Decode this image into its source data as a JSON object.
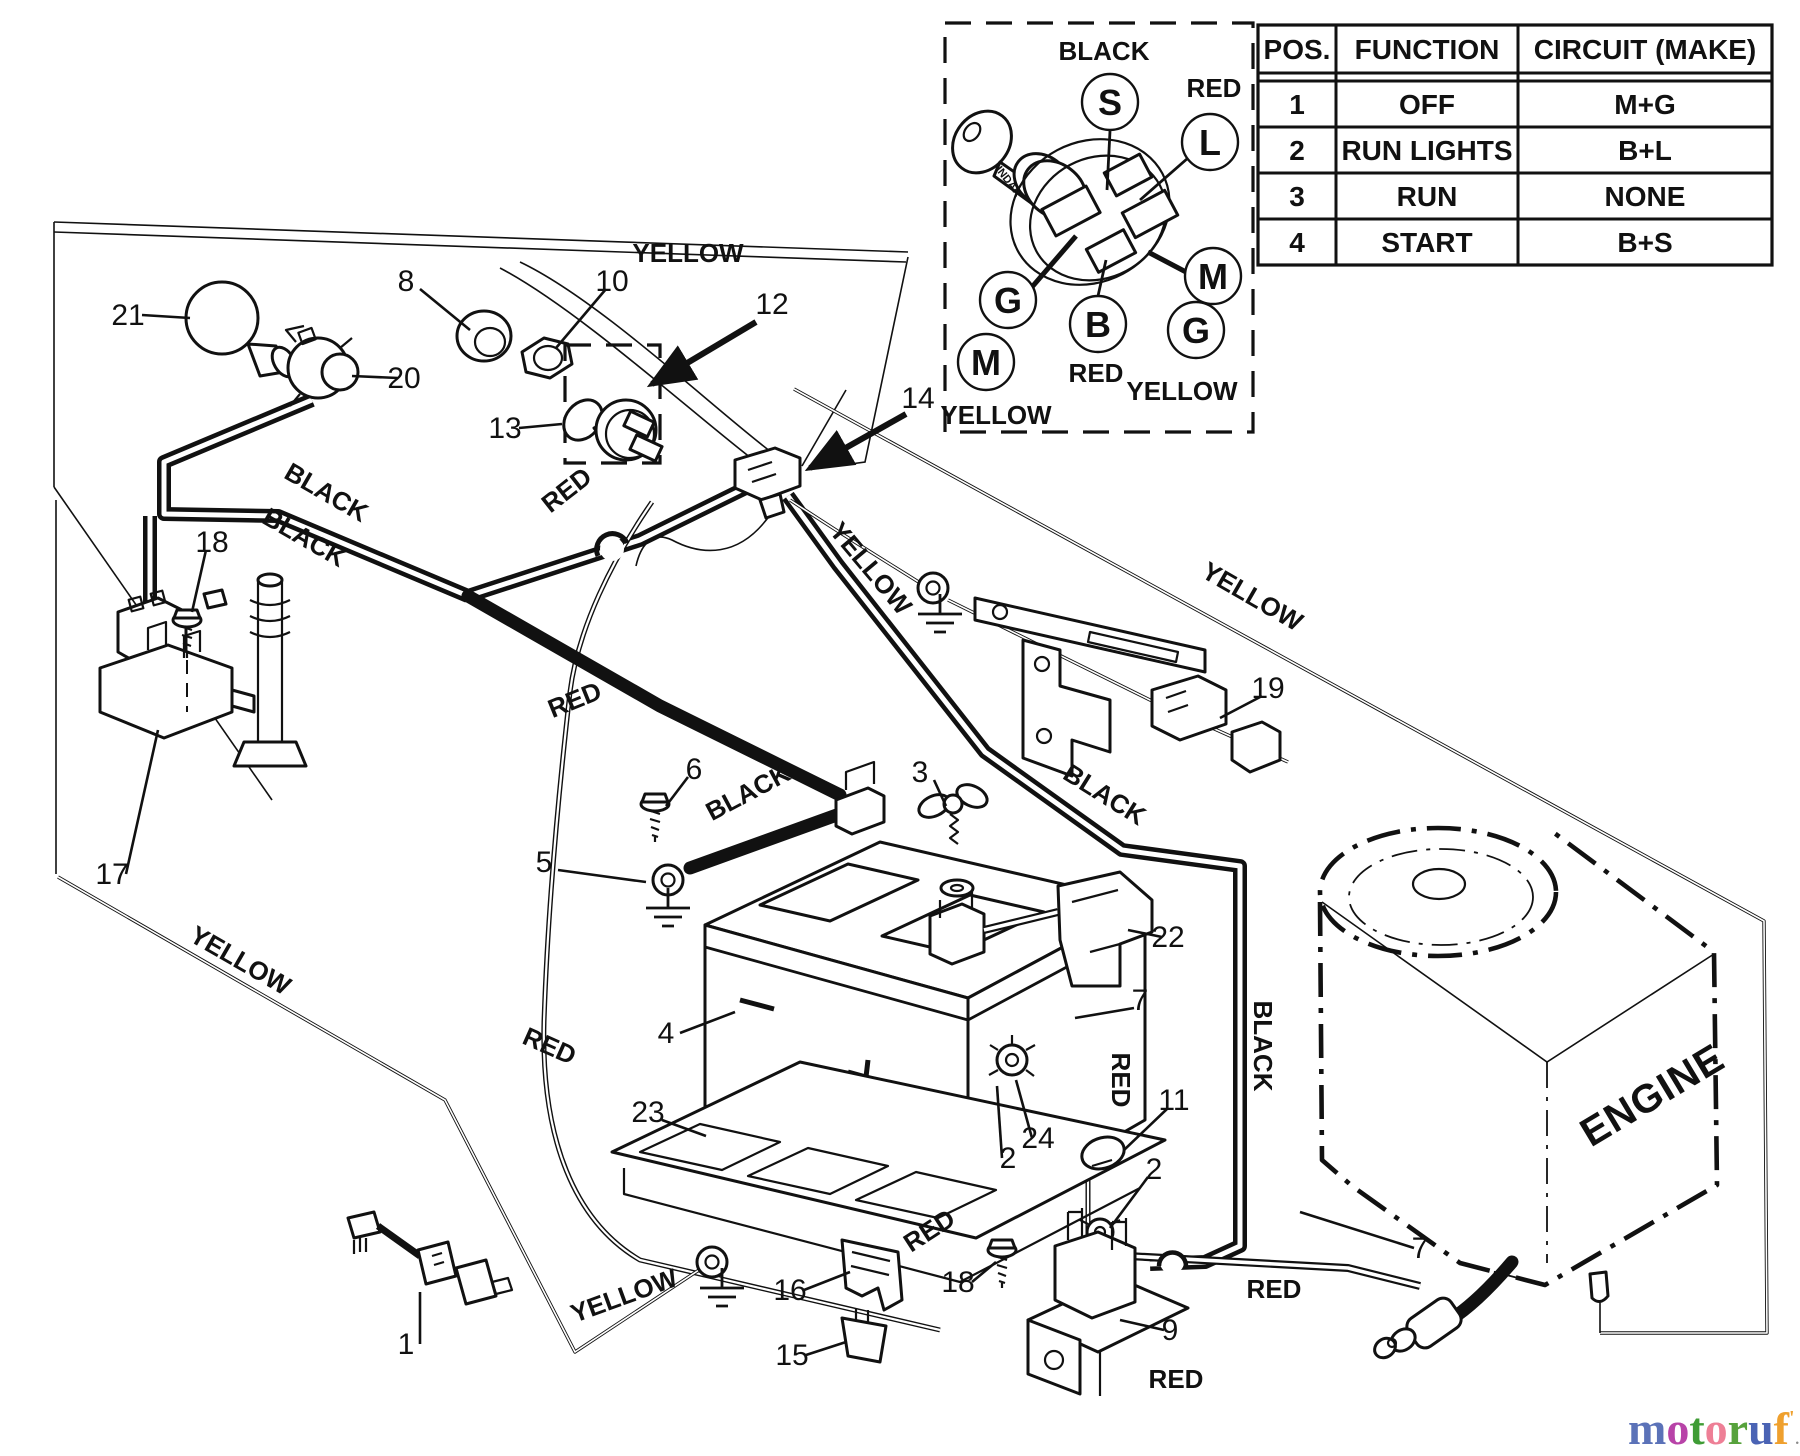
{
  "diagram": {
    "engine_label": "ENGINE",
    "inset": {
      "key_brand": "INDAK",
      "terminals": [
        {
          "t": "S",
          "x": 1110,
          "y": 102
        },
        {
          "t": "L",
          "x": 1210,
          "y": 142
        },
        {
          "t": "M",
          "x": 1213,
          "y": 276
        },
        {
          "t": "G",
          "x": 1196,
          "y": 330
        },
        {
          "t": "B",
          "x": 1098,
          "y": 324
        },
        {
          "t": "G",
          "x": 1008,
          "y": 300
        },
        {
          "t": "M",
          "x": 986,
          "y": 362
        }
      ],
      "wire_labels": [
        {
          "text": "BLACK",
          "x": 1104,
          "y": 60
        },
        {
          "text": "RED",
          "x": 1214,
          "y": 97
        },
        {
          "text": "RED",
          "x": 1096,
          "y": 382
        },
        {
          "text": "YELLOW",
          "x": 1182,
          "y": 400
        },
        {
          "text": "YELLOW",
          "x": 996,
          "y": 424
        }
      ]
    },
    "table": {
      "headers": [
        "POS.",
        "FUNCTION",
        "CIRCUIT  (MAKE)"
      ],
      "rows": [
        [
          "1",
          "OFF",
          "M+G"
        ],
        [
          "2",
          "RUN LIGHTS",
          "B+L"
        ],
        [
          "3",
          "RUN",
          "NONE"
        ],
        [
          "4",
          "START",
          "B+S"
        ]
      ]
    },
    "wire_color_labels": [
      {
        "text": "YELLOW",
        "x": 688,
        "y": 262,
        "rot": 0
      },
      {
        "text": "BLACK",
        "x": 322,
        "y": 500,
        "rot": 30
      },
      {
        "text": "BLACK",
        "x": 300,
        "y": 545,
        "rot": 30
      },
      {
        "text": "RED",
        "x": 572,
        "y": 497,
        "rot": -38
      },
      {
        "text": "RED",
        "x": 578,
        "y": 708,
        "rot": -22
      },
      {
        "text": "YELLOW",
        "x": 236,
        "y": 968,
        "rot": 30
      },
      {
        "text": "RED",
        "x": 546,
        "y": 1054,
        "rot": 24
      },
      {
        "text": "YELLOW",
        "x": 864,
        "y": 574,
        "rot": 50
      },
      {
        "text": "YELLOW",
        "x": 1248,
        "y": 604,
        "rot": 30
      },
      {
        "text": "BLACK",
        "x": 1100,
        "y": 802,
        "rot": 32
      },
      {
        "text": "BLACK",
        "x": 752,
        "y": 800,
        "rot": -28
      },
      {
        "text": "RED",
        "x": 1112,
        "y": 1080,
        "rot": 90
      },
      {
        "text": "BLACK",
        "x": 1254,
        "y": 1046,
        "rot": 90
      },
      {
        "text": "RED",
        "x": 934,
        "y": 1238,
        "rot": -33
      },
      {
        "text": "RED",
        "x": 1274,
        "y": 1298,
        "rot": 0
      },
      {
        "text": "RED",
        "x": 1176,
        "y": 1388,
        "rot": 0
      },
      {
        "text": "YELLOW",
        "x": 627,
        "y": 1304,
        "rot": -20
      }
    ],
    "part_labels": [
      {
        "n": "21",
        "x": 128,
        "y": 325,
        "tx": 190,
        "ty": 318
      },
      {
        "n": "8",
        "x": 406,
        "y": 291,
        "tx": 470,
        "ty": 330
      },
      {
        "n": "20",
        "x": 404,
        "y": 388,
        "tx": 352,
        "ty": 376
      },
      {
        "n": "10",
        "x": 612,
        "y": 291,
        "tx": 556,
        "ty": 348
      },
      {
        "n": "13",
        "x": 505,
        "y": 438,
        "tx": 562,
        "ty": 424
      },
      {
        "n": "12",
        "x": 772,
        "y": 314,
        "tx": 0,
        "ty": 0
      },
      {
        "n": "14",
        "x": 918,
        "y": 408,
        "tx": 0,
        "ty": 0
      },
      {
        "n": "18",
        "x": 212,
        "y": 552,
        "tx": 192,
        "ty": 612
      },
      {
        "n": "17",
        "x": 112,
        "y": 884,
        "tx": 158,
        "ty": 730
      },
      {
        "n": "19",
        "x": 1268,
        "y": 698,
        "tx": 1220,
        "ty": 718
      },
      {
        "n": "6",
        "x": 694,
        "y": 779,
        "tx": 666,
        "ty": 806
      },
      {
        "n": "5",
        "x": 544,
        "y": 872,
        "tx": 646,
        "ty": 882
      },
      {
        "n": "3",
        "x": 920,
        "y": 782,
        "tx": 946,
        "ty": 806
      },
      {
        "n": "4",
        "x": 666,
        "y": 1043,
        "tx": 735,
        "ty": 1012
      },
      {
        "n": "23",
        "x": 648,
        "y": 1122,
        "tx": 706,
        "ty": 1136
      },
      {
        "n": "22",
        "x": 1168,
        "y": 947,
        "tx": 1128,
        "ty": 930
      },
      {
        "n": "7",
        "x": 1140,
        "y": 1010,
        "tx": 1075,
        "ty": 1018
      },
      {
        "n": "11",
        "x": 1174,
        "y": 1110,
        "tx": 1124,
        "ty": 1150
      },
      {
        "n": "2",
        "x": 1154,
        "y": 1179,
        "tx": 1110,
        "ty": 1228
      },
      {
        "n": "24",
        "x": 1038,
        "y": 1148,
        "tx": 1016,
        "ty": 1080
      },
      {
        "n": "2",
        "x": 1008,
        "y": 1168,
        "tx": 997,
        "ty": 1086
      },
      {
        "n": "1",
        "x": 406,
        "y": 1354,
        "tx": 420,
        "ty": 1292
      },
      {
        "n": "16",
        "x": 790,
        "y": 1300,
        "tx": 850,
        "ty": 1272
      },
      {
        "n": "15",
        "x": 792,
        "y": 1365,
        "tx": 846,
        "ty": 1342
      },
      {
        "n": "18",
        "x": 958,
        "y": 1292,
        "tx": 996,
        "ty": 1262
      },
      {
        "n": "9",
        "x": 1170,
        "y": 1340,
        "tx": 1120,
        "ty": 1320
      },
      {
        "n": "7",
        "x": 1420,
        "y": 1258,
        "tx": 1300,
        "ty": 1212
      }
    ],
    "logo": {
      "letters": [
        {
          "ch": "m",
          "color": "#5b72b8"
        },
        {
          "ch": "o",
          "color": "#b843a8"
        },
        {
          "ch": "t",
          "color": "#3f9c35"
        },
        {
          "ch": "o",
          "color": "#ee7f96"
        },
        {
          "ch": "r",
          "color": "#57a23c"
        },
        {
          "ch": "u",
          "color": "#4a63b4"
        },
        {
          "ch": "f",
          "color": "#efa02e"
        },
        {
          "ch": "'",
          "color": "#efa02e"
        }
      ],
      "suffix": ".de"
    }
  }
}
